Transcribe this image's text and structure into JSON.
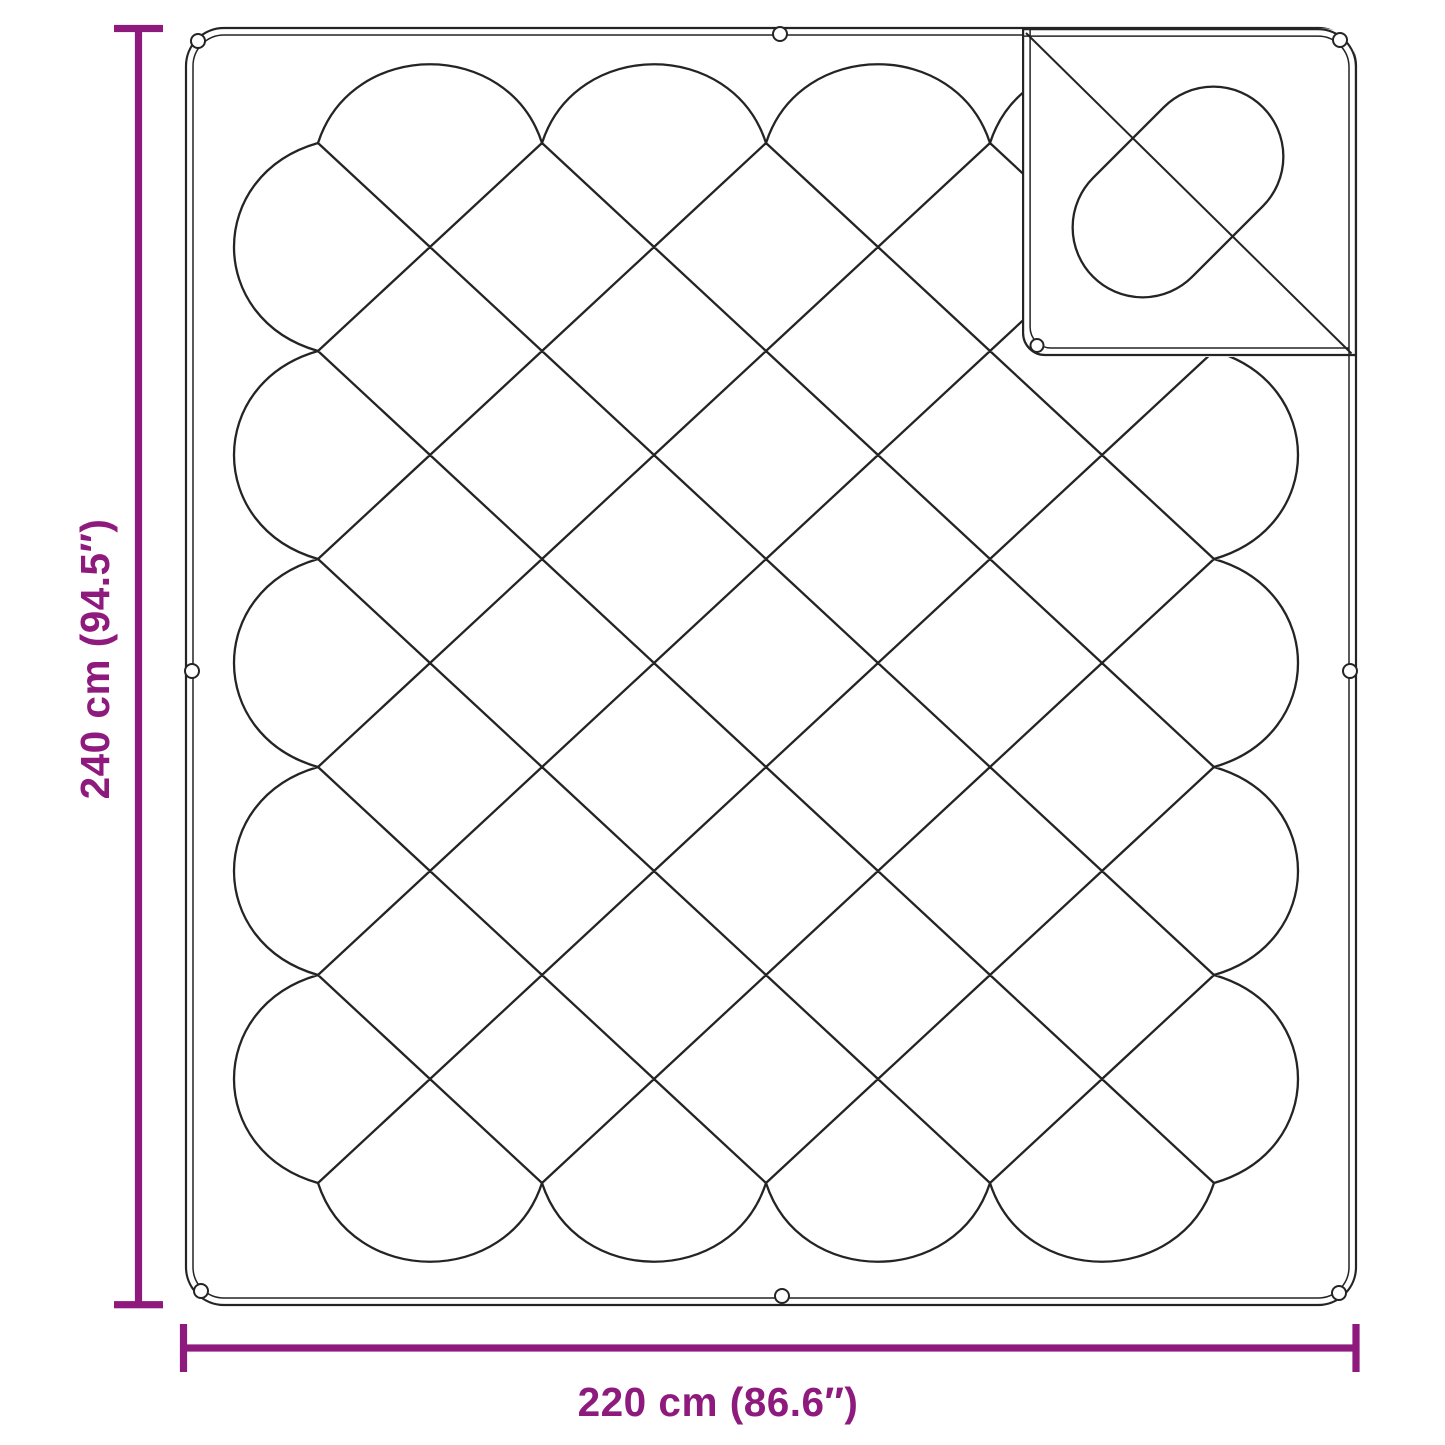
{
  "diagram": {
    "height_dimension": {
      "label": "240 cm (94.5″)"
    },
    "width_dimension": {
      "label": "220 cm (86.6″)"
    }
  },
  "colors": {
    "accent": "#8E1A7D",
    "line_art": "#242424",
    "background": "#FFFFFF"
  }
}
